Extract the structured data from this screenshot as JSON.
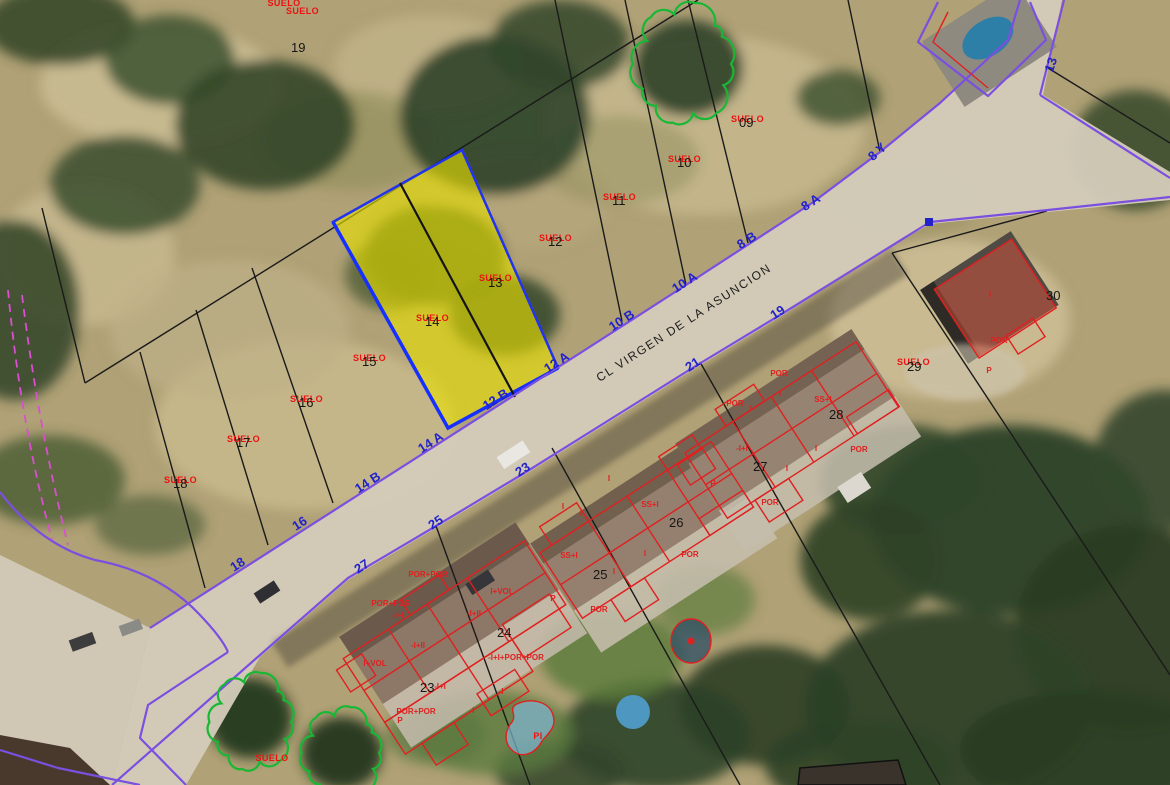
{
  "map": {
    "street": {
      "name": "CL VIRGEN DE LA ASUNCION",
      "x": 686,
      "y": 326,
      "rot": -33
    },
    "colors": {
      "boundary_purple": "#7b4fe0",
      "cadastral_black": "#1a1a1a",
      "overlay_red": "#e02020",
      "label_red": "#ee1111",
      "street_number_blue": "#2222cc",
      "selection_yellow": "#e8e000",
      "selection_edge_blue": "#2233ee",
      "tree_green": "#17b834",
      "utility_pink": "#d94fd0"
    },
    "parcels": [
      {
        "tag": "SUELO",
        "number": "19",
        "x": 291,
        "y": 52,
        "sx": 286,
        "sy": 7
      },
      {
        "tag": "SUELO",
        "number": "09",
        "x": 739,
        "y": 127,
        "sx": 731,
        "sy": 115
      },
      {
        "tag": "SUELO",
        "number": "10",
        "x": 677,
        "y": 167,
        "sx": 668,
        "sy": 155
      },
      {
        "tag": "SUELO",
        "number": "11",
        "x": 612,
        "y": 205,
        "sx": 603,
        "sy": 193
      },
      {
        "tag": "SUELO",
        "number": "12",
        "x": 548,
        "y": 246,
        "sx": 539,
        "sy": 234
      },
      {
        "tag": "SUELO",
        "number": "13",
        "x": 488,
        "y": 287,
        "sx": 479,
        "sy": 274
      },
      {
        "tag": "SUELO",
        "number": "14",
        "x": 425,
        "y": 326,
        "sx": 416,
        "sy": 314
      },
      {
        "tag": "SUELO",
        "number": "15",
        "x": 362,
        "y": 366,
        "sx": 353,
        "sy": 354
      },
      {
        "tag": "SUELO",
        "number": "16",
        "x": 299,
        "y": 407,
        "sx": 290,
        "sy": 395
      },
      {
        "tag": "SUELO",
        "number": "17",
        "x": 236,
        "y": 447,
        "sx": 227,
        "sy": 435
      },
      {
        "tag": "SUELO",
        "number": "18",
        "x": 173,
        "y": 488,
        "sx": 164,
        "sy": 476
      },
      {
        "tag": "SUELO",
        "number": "29",
        "x": 907,
        "y": 371,
        "sx": 897,
        "sy": 358
      },
      {
        "tag": null,
        "number": "23",
        "x": 420,
        "y": 692
      },
      {
        "tag": null,
        "number": "24",
        "x": 497,
        "y": 637
      },
      {
        "tag": null,
        "number": "25",
        "x": 593,
        "y": 579
      },
      {
        "tag": null,
        "number": "26",
        "x": 669,
        "y": 527
      },
      {
        "tag": null,
        "number": "27",
        "x": 753,
        "y": 471
      },
      {
        "tag": null,
        "number": "28",
        "x": 829,
        "y": 419
      },
      {
        "tag": null,
        "number": "30",
        "x": 1046,
        "y": 300
      }
    ],
    "street_numbers": [
      {
        "label": "8 Y",
        "x": 880,
        "y": 155,
        "rot": -42
      },
      {
        "label": "8 A",
        "x": 813,
        "y": 206,
        "rot": -33
      },
      {
        "label": "8 B",
        "x": 749,
        "y": 244,
        "rot": -33
      },
      {
        "label": "10 A",
        "x": 687,
        "y": 286,
        "rot": -33
      },
      {
        "label": "10 B",
        "x": 624,
        "y": 324,
        "rot": -33
      },
      {
        "label": "12 A",
        "x": 559,
        "y": 366,
        "rot": -33
      },
      {
        "label": "12 B",
        "x": 498,
        "y": 403,
        "rot": -33
      },
      {
        "label": "14 A",
        "x": 433,
        "y": 446,
        "rot": -33
      },
      {
        "label": "14 B",
        "x": 370,
        "y": 486,
        "rot": -33
      },
      {
        "label": "16",
        "x": 302,
        "y": 527,
        "rot": -33
      },
      {
        "label": "18",
        "x": 240,
        "y": 568,
        "rot": -33
      },
      {
        "label": "19",
        "x": 780,
        "y": 316,
        "rot": -33
      },
      {
        "label": "21",
        "x": 695,
        "y": 368,
        "rot": -33
      },
      {
        "label": "23",
        "x": 525,
        "y": 473,
        "rot": -33
      },
      {
        "label": "25",
        "x": 438,
        "y": 526,
        "rot": -33
      },
      {
        "label": "27",
        "x": 364,
        "y": 570,
        "rot": -33
      },
      {
        "label": "13",
        "x": 1055,
        "y": 66,
        "rot": -72
      }
    ],
    "building_labels": [
      {
        "t": "POR+POR",
        "x": 428,
        "y": 577
      },
      {
        "t": "I+VOL",
        "x": 502,
        "y": 594
      },
      {
        "t": "POR+POR",
        "x": 391,
        "y": 606
      },
      {
        "t": "-I+I",
        "x": 398,
        "y": 618
      },
      {
        "t": "-I+II",
        "x": 474,
        "y": 616
      },
      {
        "t": "-I+II",
        "x": 418,
        "y": 648
      },
      {
        "t": "-I+I+POR+POR",
        "x": 516,
        "y": 660
      },
      {
        "t": "I+VOL",
        "x": 375,
        "y": 666
      },
      {
        "t": "-I+I",
        "x": 440,
        "y": 689
      },
      {
        "t": "-I",
        "x": 501,
        "y": 694
      },
      {
        "t": "-I",
        "x": 472,
        "y": 713
      },
      {
        "t": "POR+POR",
        "x": 416,
        "y": 714
      },
      {
        "t": "P",
        "x": 400,
        "y": 723
      },
      {
        "t": "I",
        "x": 609,
        "y": 481
      },
      {
        "t": "I",
        "x": 563,
        "y": 509
      },
      {
        "t": "I",
        "x": 581,
        "y": 516
      },
      {
        "t": "SS+I",
        "x": 650,
        "y": 507
      },
      {
        "t": "SS+I",
        "x": 569,
        "y": 558
      },
      {
        "t": "I",
        "x": 645,
        "y": 556
      },
      {
        "t": "POR",
        "x": 690,
        "y": 557
      },
      {
        "t": "I",
        "x": 614,
        "y": 574
      },
      {
        "t": "POR",
        "x": 599,
        "y": 612
      },
      {
        "t": "P",
        "x": 553,
        "y": 601
      },
      {
        "t": "POR",
        "x": 779,
        "y": 376
      },
      {
        "t": "I",
        "x": 780,
        "y": 396
      },
      {
        "t": "POR",
        "x": 735,
        "y": 406
      },
      {
        "t": "I",
        "x": 751,
        "y": 411
      },
      {
        "t": "SS+I",
        "x": 823,
        "y": 402
      },
      {
        "t": "-I+I",
        "x": 742,
        "y": 451
      },
      {
        "t": "I",
        "x": 816,
        "y": 451
      },
      {
        "t": "POR",
        "x": 859,
        "y": 452
      },
      {
        "t": "I",
        "x": 787,
        "y": 471
      },
      {
        "t": "POR",
        "x": 770,
        "y": 505
      },
      {
        "t": "P",
        "x": 713,
        "y": 486
      },
      {
        "t": "I",
        "x": 990,
        "y": 297
      },
      {
        "t": "POR",
        "x": 999,
        "y": 343
      },
      {
        "t": "P",
        "x": 989,
        "y": 373
      }
    ],
    "extra_labels": [
      {
        "t": "SUELO",
        "x": 272,
        "y": 761
      },
      {
        "t": "SUELO",
        "x": 284,
        "y": 6
      },
      {
        "t": "PI",
        "x": 538,
        "y": 739
      }
    ],
    "trees": [
      {
        "cx": 684,
        "cy": 64,
        "rx": 47,
        "ry": 56
      },
      {
        "cx": 252,
        "cy": 722,
        "rx": 39,
        "ry": 45
      },
      {
        "cx": 342,
        "cy": 753,
        "rx": 37,
        "ry": 42
      }
    ]
  }
}
